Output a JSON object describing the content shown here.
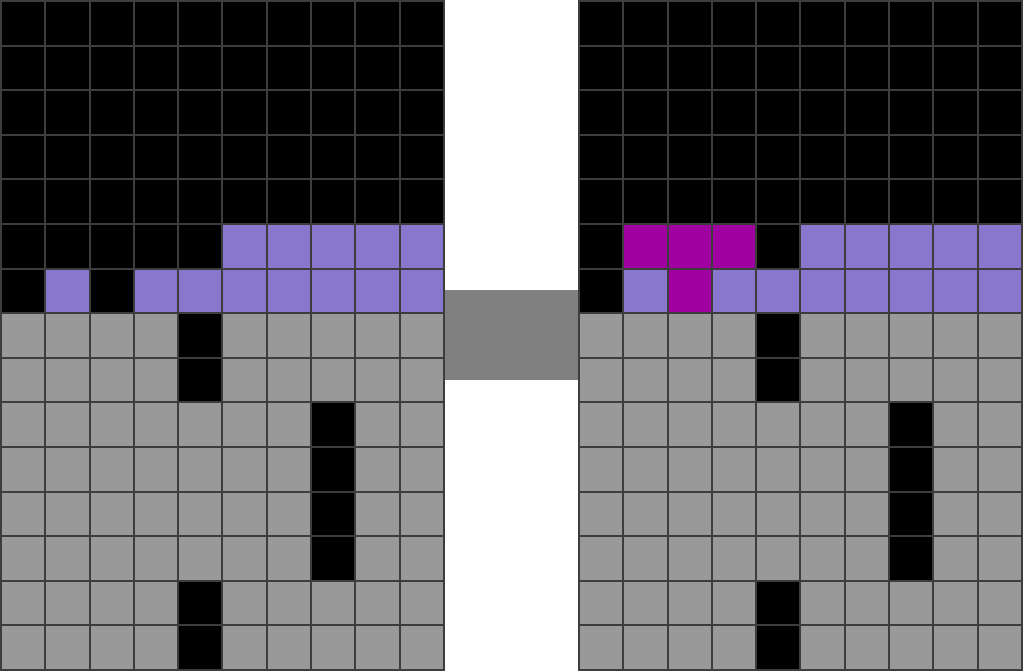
{
  "scene": {
    "kind": "tile-grid-game-view",
    "gap_color": "#ffffff",
    "line_color": "#3d3d3d",
    "bridge_color": "#808080",
    "palette": {
      "K": "#000000",
      "G": "#999999",
      "P": "#8976CD",
      "M": "#A000A0"
    },
    "left_grid": {
      "id": "left-grid",
      "cols": 10,
      "rows": [
        "KKKKKKKKKK",
        "KKKKKKKKKK",
        "KKKKKKKKKK",
        "KKKKKKKKKK",
        "KKKKKKKKKK",
        "KKKKKPPPPP",
        "KPKPPPPPPP",
        "GGGGKGGGGG",
        "GGGGKGGGGG",
        "GGGGGGGKGG",
        "GGGGGGGKGG",
        "GGGGGGGKGG",
        "GGGGGGGKGG",
        "GGGGKGGGGG",
        "GGGGKGGGGG"
      ]
    },
    "right_grid": {
      "id": "right-grid",
      "cols": 10,
      "rows": [
        "KKKKKKKKKK",
        "KKKKKKKKKK",
        "KKKKKKKKKK",
        "KKKKKKKKKK",
        "KKKKKKKKKK",
        "KMMMKPPPPP",
        "KPMPPPPPPP",
        "GGGGKGGGGG",
        "GGGGKGGGGG",
        "GGGGGGGKGG",
        "GGGGGGGKGG",
        "GGGGGGGKGG",
        "GGGGGGGKGG",
        "GGGGKGGGGG",
        "GGGGKGGGGG"
      ]
    }
  }
}
